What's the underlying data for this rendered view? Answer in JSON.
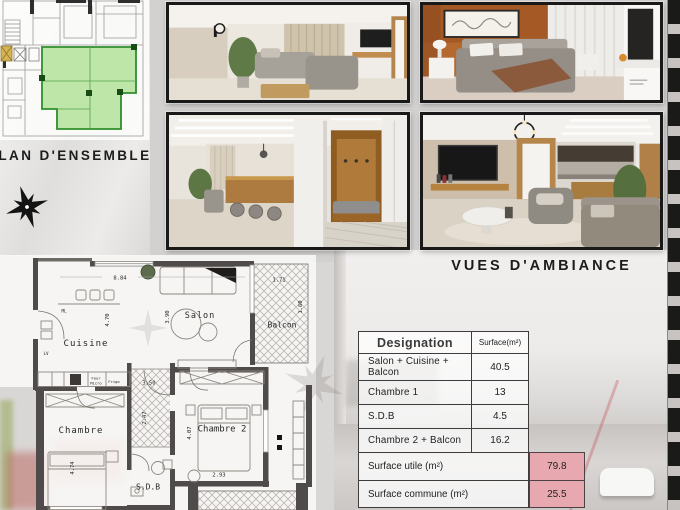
{
  "titles": {
    "overview": "Plan D'ensemble",
    "ambiance": "Vues D'ambiance"
  },
  "icons": {
    "compass": "compass-rose-star",
    "watermark": "compass-star-watermark"
  },
  "photos": {
    "p1": "salon-interior-render",
    "p2": "bedroom-interior-render",
    "p3": "kitchen-entry-interior-render",
    "p4": "tv-lounge-interior-render"
  },
  "floor_plan": {
    "rooms": {
      "cuisine": "Cuisine",
      "salon": "Salon",
      "balcon": "Balcon",
      "chambre1": "Chambre",
      "chambre2": "Chambre 2",
      "sdb": "S.D.B"
    },
    "dims": {
      "width_total": "8.84",
      "balcon_w": "1.71",
      "kitchen_h": "4.70",
      "salon_h": "3.90",
      "balcon_h": "1.60",
      "hall_w": "3.50",
      "hall_h": "2.47",
      "chambre1_h": "4.74",
      "chambre2_h": "4.07",
      "chambre2_w": "2.93"
    },
    "appliances": {
      "ml": "ML",
      "lv": "LV",
      "four": "Four",
      "micro": "Micro",
      "frigo": "Frigo"
    }
  },
  "surface_table": {
    "header": {
      "designation": "Designation",
      "surface": "Surface(m²)"
    },
    "rows": [
      {
        "label": "Salon + Cuisine + Balcon",
        "value": "40.5"
      },
      {
        "label": "Chambre 1",
        "value": "13"
      },
      {
        "label": "S.D.B",
        "value": "4.5"
      },
      {
        "label": "Chambre 2 + Balcon",
        "value": "16.2"
      }
    ],
    "summary": [
      {
        "label": "Surface utile (m²)",
        "value": "79.8"
      },
      {
        "label": "Surface commune (m²)",
        "value": "25.5"
      }
    ]
  },
  "colors": {
    "unit_highlight": "#6fc74e",
    "summary_cell": "#e7a8af",
    "wall": "#4f4b4a"
  }
}
